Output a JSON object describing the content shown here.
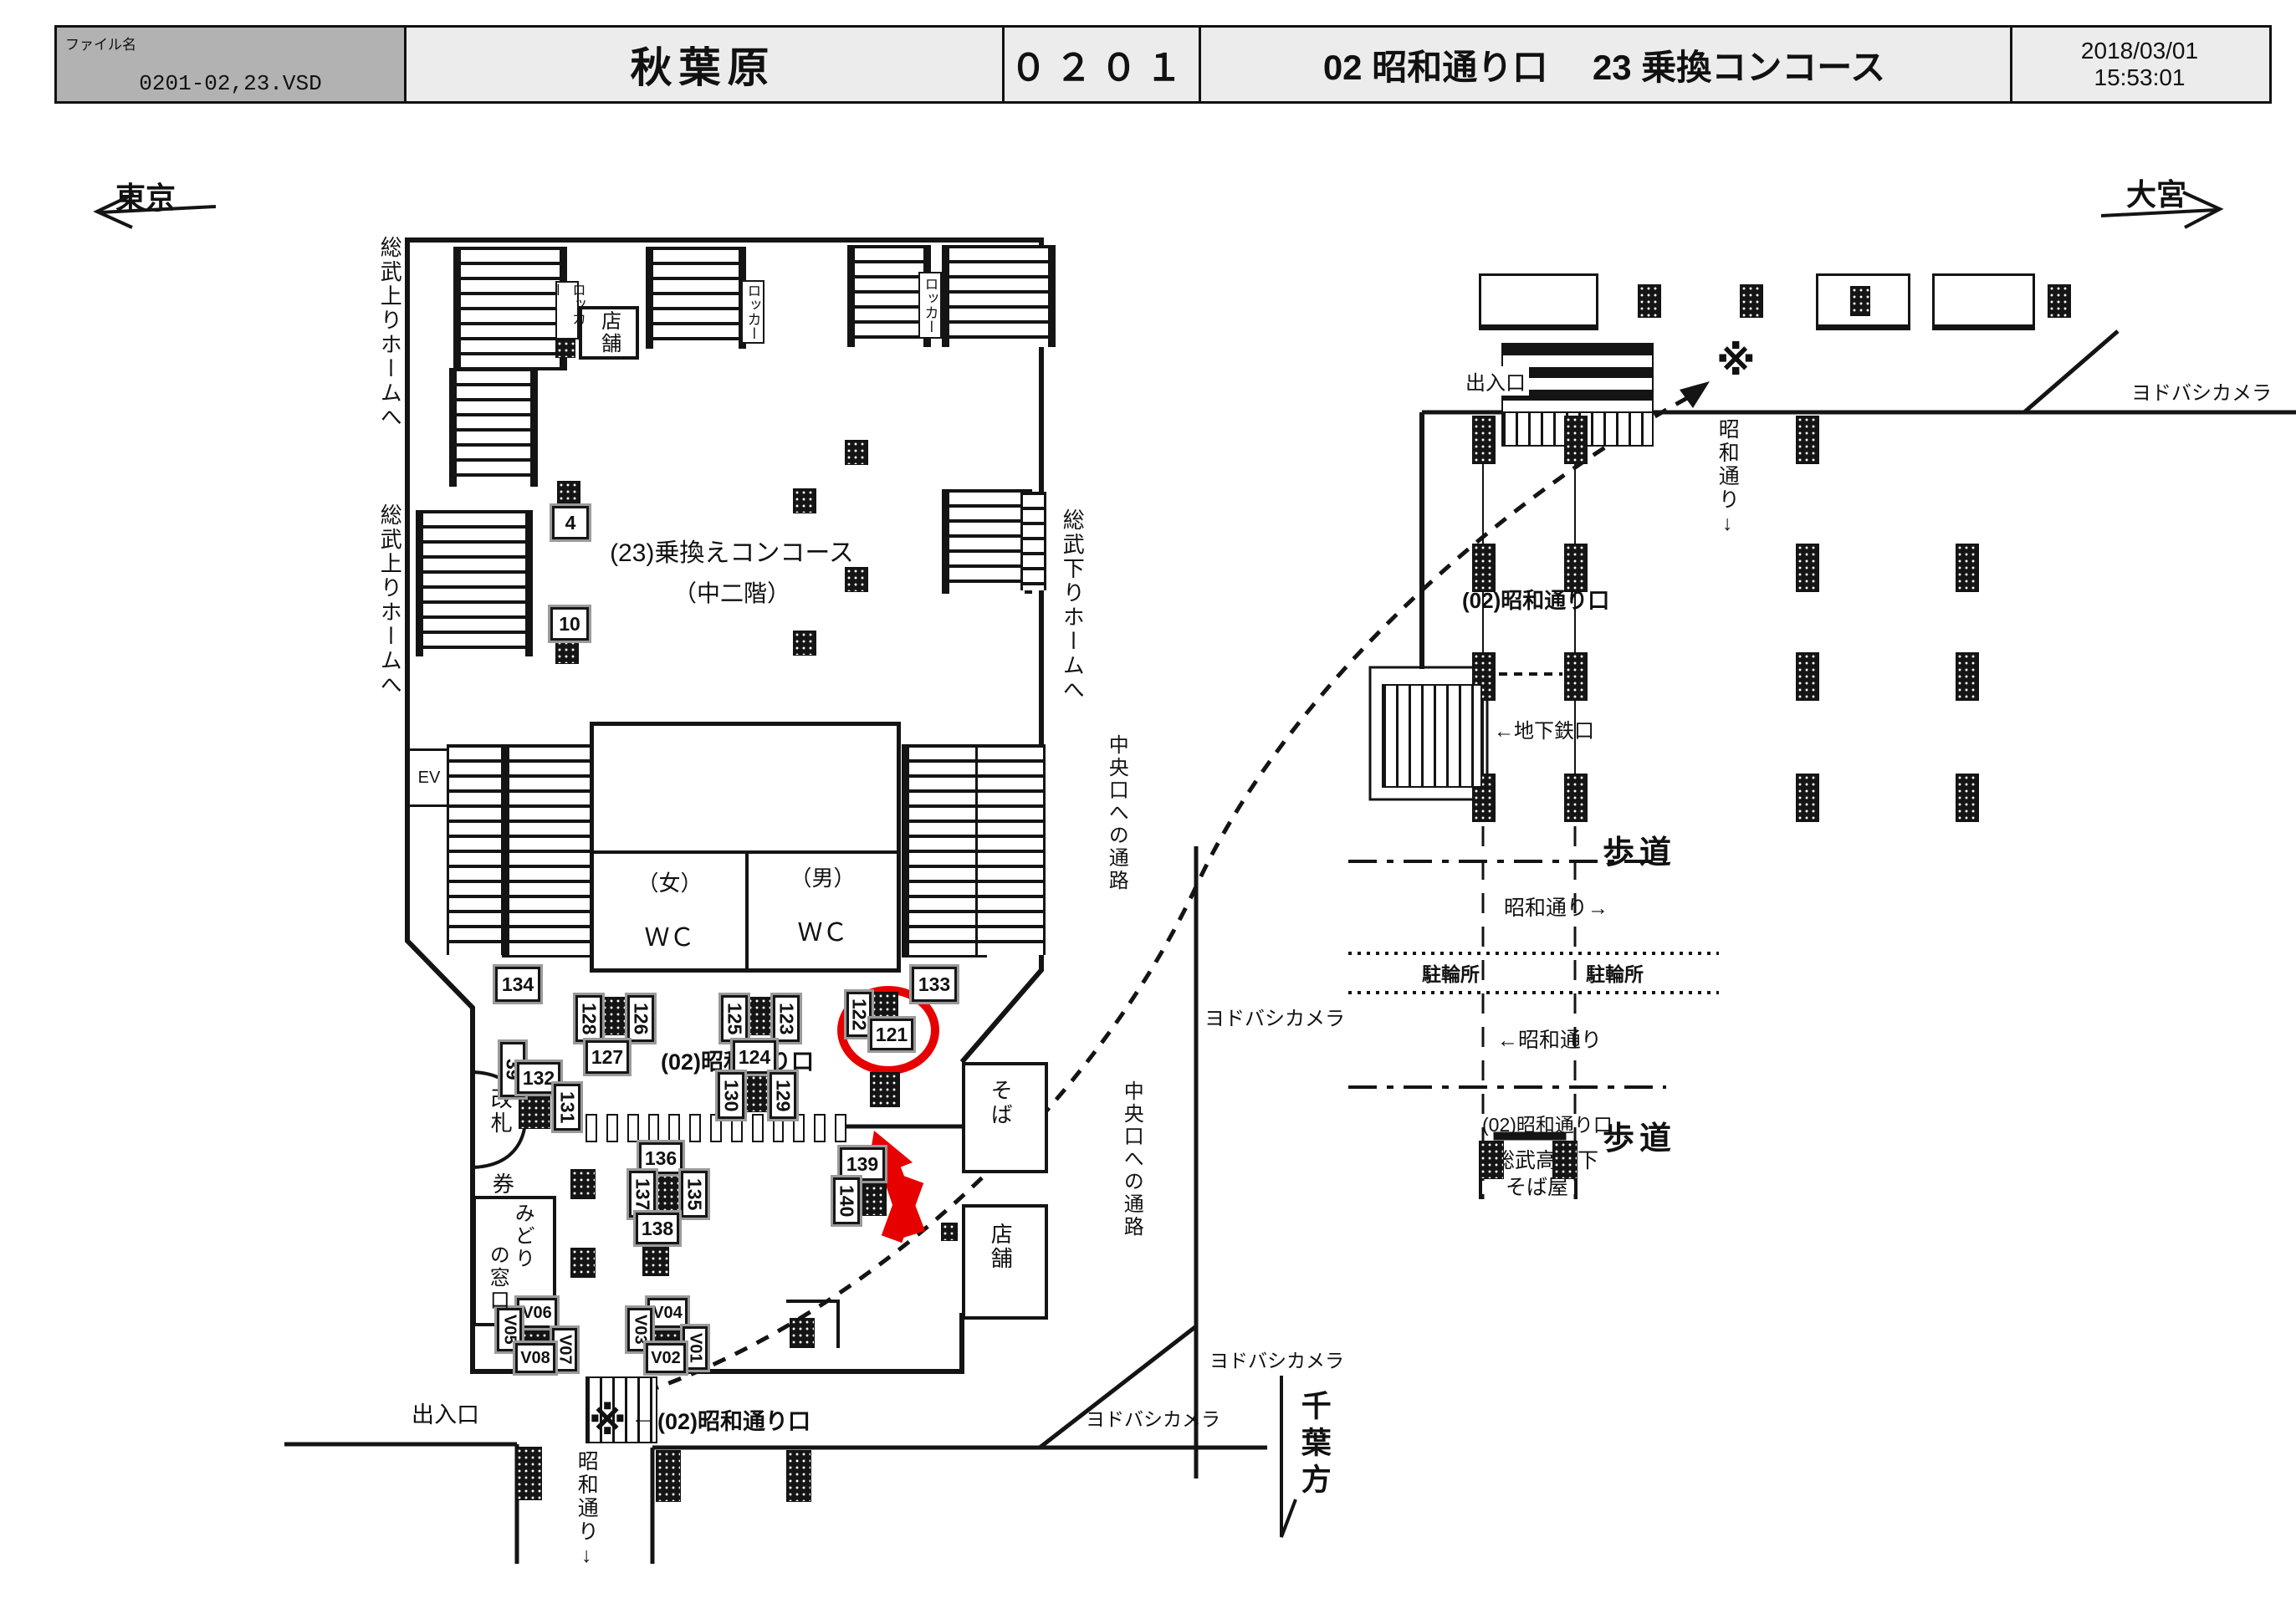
{
  "header": {
    "file_label": "ファイル名",
    "file_name": "0201-02,23.VSD",
    "station": "秋葉原",
    "code": "０２０１",
    "section": "02 昭和通り口　 23 乗換コンコース",
    "date": "2018/03/01",
    "time": "15:53:01"
  },
  "compass": {
    "west": "東京",
    "east": "大宮"
  },
  "labels": {
    "sobu_up": "総武上りホームへ",
    "sobu_down": "総武下りホームへ",
    "concourse": "(23)乗換えコンコース",
    "mezzanine": "（中二階）",
    "locker": "ロッカー",
    "tenpo": "店舗",
    "ev": "EV",
    "women": "（女）",
    "men": "（男）",
    "wc": "ＷＣ",
    "kaisatsu": "改札",
    "ticket_office": "券売機室",
    "midori": "みどり",
    "no_madoguchi": "の窓口",
    "showa_exit": "(02)昭和通り口",
    "exit": "出入口",
    "showa_dori_down": "昭和通り↓",
    "soba": "そば",
    "chuo_passage": "中央口への通路",
    "yodobashi": "ヨドバシカメラ",
    "kome": "※",
    "arrow_left": "←",
    "chiba": "千葉方",
    "chikatetsu": "←地下鉄口",
    "hodou": "歩道",
    "showa_right": "昭和通り→",
    "showa_left": "←昭和通り",
    "churinjo": "駐輪所",
    "sobu_kouka": "総武高架下",
    "sobaya": "そば屋"
  },
  "signs": {
    "s4": "4",
    "s10": "10",
    "s39": "39",
    "s121": "121",
    "s122": "122",
    "s123": "123",
    "s124": "124",
    "s125": "125",
    "s126": "126",
    "s127": "127",
    "s128": "128",
    "s129": "129",
    "s130": "130",
    "s131": "131",
    "s132": "132",
    "s133": "133",
    "s134": "134",
    "s135": "135",
    "s136": "136",
    "s137": "137",
    "s138": "138",
    "s139": "139",
    "s140": "140",
    "v01": "V01",
    "v02": "V02",
    "v03": "V03",
    "v04": "V04",
    "v05": "V05",
    "v06": "V06",
    "v07": "V07",
    "v08": "V08"
  },
  "annotation": {
    "highlight_color": "#e60000",
    "highlighted_sign": "121"
  }
}
